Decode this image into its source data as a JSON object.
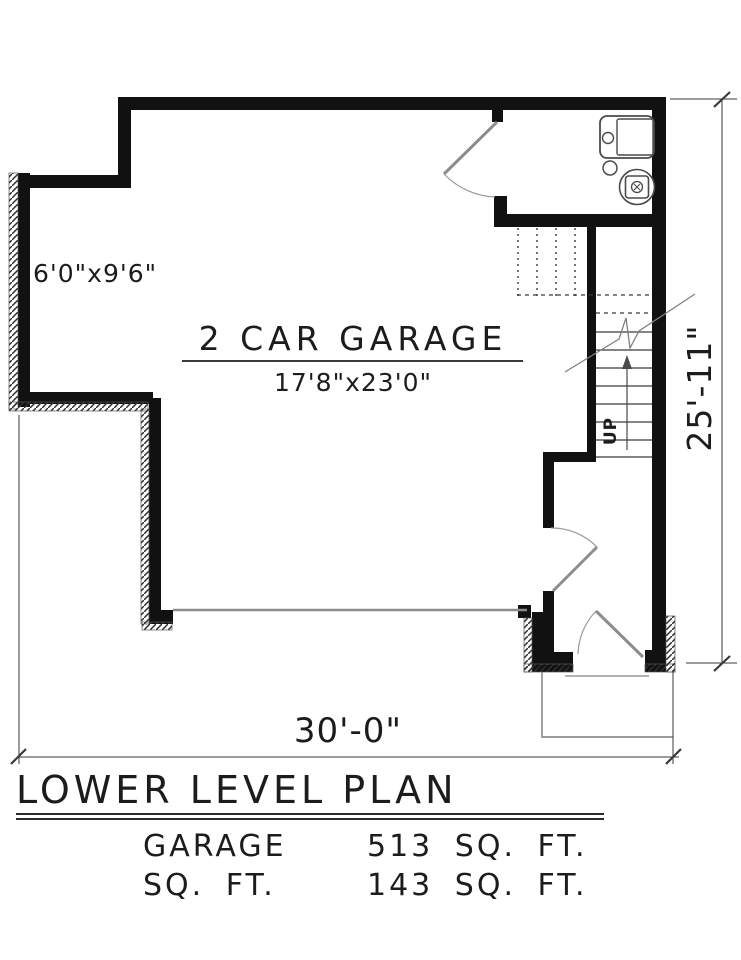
{
  "plan": {
    "garage_label": "2 CAR GARAGE",
    "garage_dimensions": "17'8\"x23'0\"",
    "alcove_dimensions": "6'0\"x9'6\"",
    "stair_label": "UP",
    "width_dimension": "30'-0\"",
    "height_dimension": "25'-11\""
  },
  "title": "LOWER LEVEL PLAN",
  "area_table": {
    "rows": [
      {
        "label": "GARAGE",
        "value": "513 SQ. FT."
      },
      {
        "label": "SQ. FT.",
        "value": "143 SQ. FT."
      }
    ]
  },
  "fixtures": {
    "sink_icon": "laundry-sink-icon",
    "drain_icon": "floor-drain-icon",
    "heater_icon": "water-heater-icon"
  },
  "colors": {
    "ink": "#181818",
    "door_gray": "#8c8c8c",
    "dimension_gray": "#3a3a3a",
    "background": "#ffffff"
  }
}
